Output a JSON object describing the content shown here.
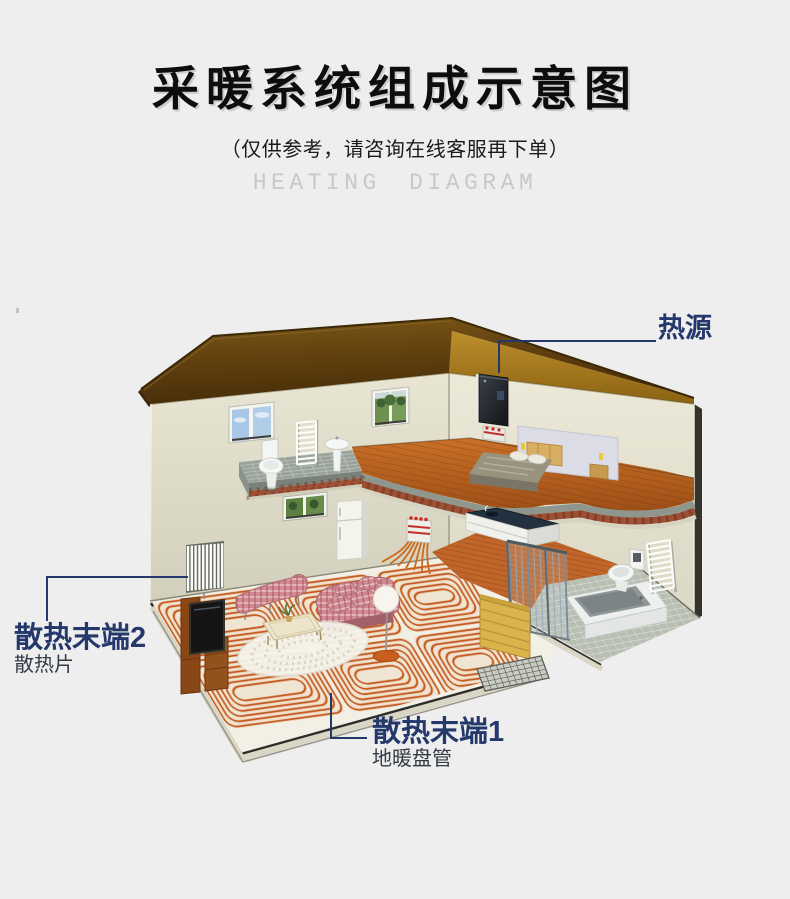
{
  "page": {
    "background": "#eeeeee"
  },
  "header": {
    "title": "采暖系统组成示意图",
    "subtitle": "（仅供参考，请咨询在线客服再下单）",
    "english_title": "HEATING DIAGRAM"
  },
  "diagram": {
    "callouts": {
      "heat_source": {
        "label": "热源"
      },
      "terminal2": {
        "label": "散热末端2",
        "sublabel": "散热片"
      },
      "terminal1": {
        "label": "散热末端1",
        "sublabel": "地暖盘管"
      }
    },
    "colors": {
      "background": "#eeeeee",
      "title_text": "#0d0d0d",
      "english_title_text": "#c8c8c8",
      "callout_text": "#24386b",
      "leader_line": "#24386b",
      "roof_top": "#5f3d10",
      "roof_underside": "#a87a1e",
      "wall": "#e3e0cd",
      "wood_floor": "#b9641f",
      "heating_coil": "#c0541c",
      "slab_tile": "#9aa39a",
      "sofa_pink": "#cf8a92",
      "partition_yellow": "#d9b44a"
    }
  }
}
